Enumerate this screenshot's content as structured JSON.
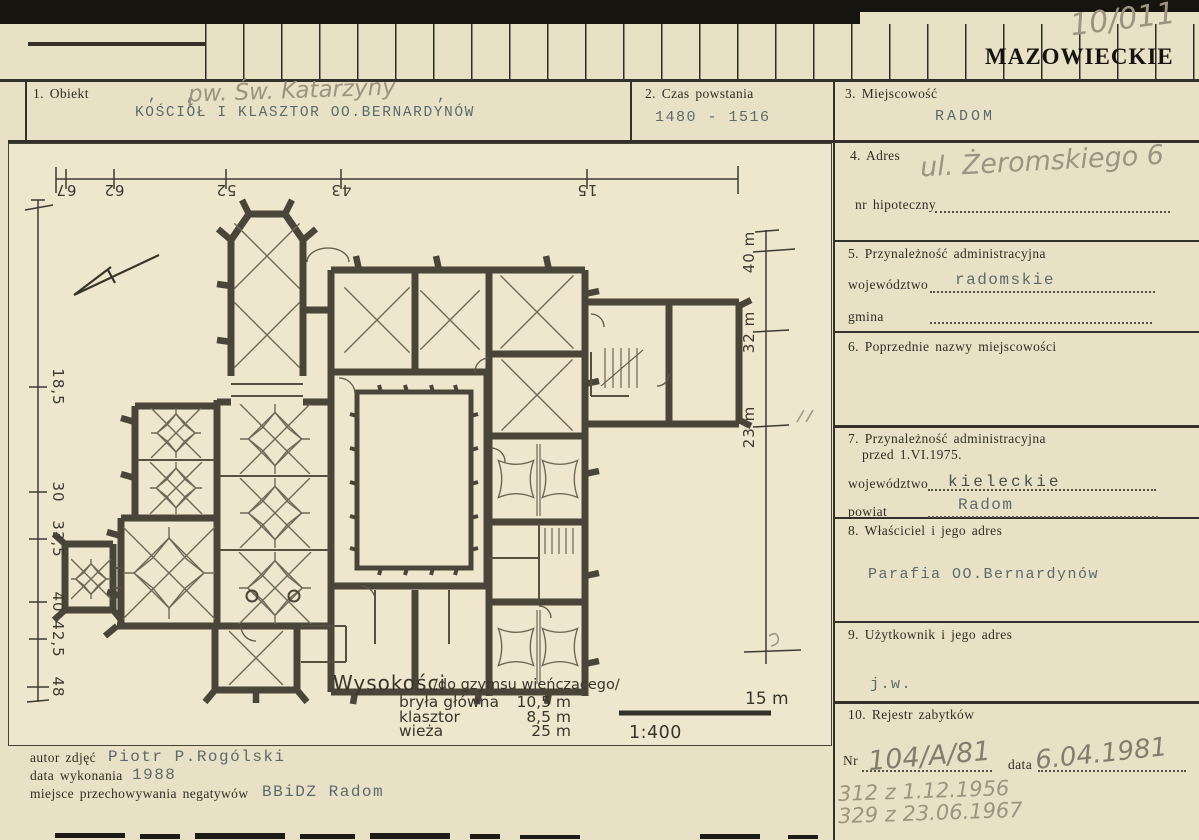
{
  "header": {
    "voivodeship_stamp": "MAZOWIECKIE",
    "archive_number": "10/011"
  },
  "row1": {
    "obiekt": {
      "label": "1. Obiekt",
      "typed_value": "KOŚCIÓŁ I KLASZTOR OO.BERNARDYNÓW",
      "pencil_annotation": "pw. Św. Katarzyny",
      "comma_left": ", ,",
      "comma_right": ","
    },
    "czas": {
      "label": "2. Czas powstania",
      "value": "1480 - 1516"
    },
    "miejscowosc": {
      "label": "3. Miejscowość",
      "value": "RADOM"
    }
  },
  "sections": {
    "adres": {
      "label": "4. Adres",
      "handwritten": "ul. Żeromskiego 6",
      "hipoteczny_label": "nr hipoteczny"
    },
    "przynaleznosc": {
      "label": "5. Przynależność administracyjna",
      "wojewodztwo_label": "województwo",
      "wojewodztwo": "radomskie",
      "gmina_label": "gmina"
    },
    "poprzednie": {
      "label": "6. Poprzednie nazwy miejscowości"
    },
    "przynaleznosc_1975": {
      "label": "7. Przynależność administracyjna",
      "label_line2": "przed 1.VI.1975.",
      "wojewodztwo_label": "województwo",
      "wojewodztwo": "kieleckie",
      "powiat_label": "powiat",
      "powiat": "Radom"
    },
    "wlasciciel": {
      "label": "8. Właściciel i jego adres",
      "value": "Parafia OO.Bernardynów"
    },
    "uzytkownik": {
      "label": "9. Użytkownik i jego adres",
      "value": "j.w."
    },
    "rejestr": {
      "label": "10. Rejestr zabytków",
      "nr_label": "Nr",
      "nr": "104/A/81",
      "data_label": "data",
      "data": "6.04.1981",
      "pencil_entries": [
        "312 z 1.12.1956",
        "329 z 23.06.1967"
      ]
    }
  },
  "plan": {
    "dim_top": [
      "67",
      "62",
      "52",
      "43",
      "15"
    ],
    "dim_left": [
      "18,5",
      "30",
      "33,5",
      "40",
      "42,5",
      "48"
    ],
    "dim_right": [
      "40 m",
      "32 m",
      "23 m"
    ],
    "heights": {
      "title": "Wysokości",
      "subtitle": "/do gzymsu wieńczącego/",
      "rows": [
        {
          "name": "bryła główna",
          "value": "10,5 m"
        },
        {
          "name": "klasztor",
          "value": "8,5 m"
        },
        {
          "name": "wieża",
          "value": "25 m"
        }
      ]
    },
    "scale": "1:400",
    "scalebar_label": "15 m"
  },
  "credits": {
    "autor_label": "autor zdjęć",
    "autor": "Piotr P.Rogólski",
    "data_label": "data wykonania",
    "data": "1988",
    "negatywy_label": "miejsce przechowywania negatywów",
    "negatywy": "BBiDZ Radom"
  }
}
